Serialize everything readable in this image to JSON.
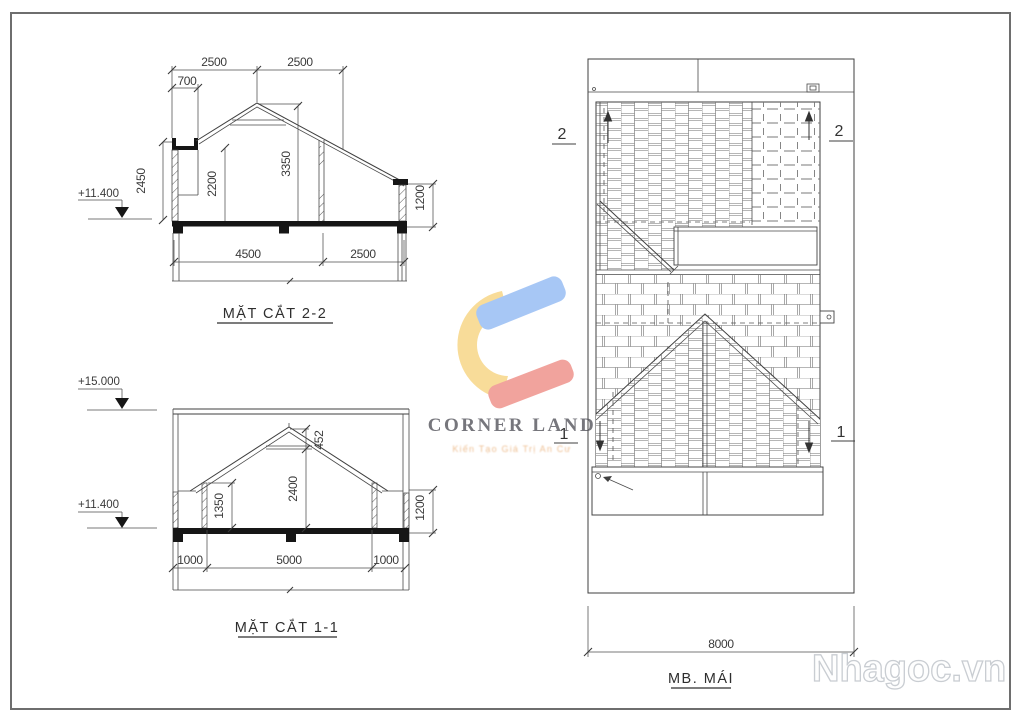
{
  "page": {
    "border_color": "#6e6e6e"
  },
  "sections": {
    "section_2_2": {
      "title": "MẶT CẮT 2-2",
      "level": "+11.400",
      "dim_top_left": "2500",
      "dim_top_right": "2500",
      "dim_eave": "700",
      "dim_parapet_height": "2450",
      "dim_ceiling_left": "2200",
      "dim_ridge_height": "3350",
      "dim_right_wall": "1200",
      "dim_span_main": "4500",
      "dim_span_right": "2500"
    },
    "section_1_1": {
      "title": "MẶT CẮT 1-1",
      "level_top": "+15.000",
      "level_floor": "+11.400",
      "dim_ridge_offset": "452",
      "dim_attic_height": "2400",
      "dim_wall_height": "1350",
      "dim_right_wall": "1200",
      "dim_span_left": "1000",
      "dim_span_mid": "5000",
      "dim_span_right": "1000"
    },
    "roof_plan": {
      "title": "MB. MÁI",
      "dim_width": "8000",
      "marker_2_left": "2",
      "marker_2_right": "2",
      "marker_1_left": "1",
      "marker_1_right": "1"
    }
  },
  "watermarks": {
    "logo_title": "CORNER LAND",
    "logo_tagline": "Kiến Tạo Giá Trị An Cư",
    "site": "Nhagoc.vn",
    "logo_colors": {
      "blue": "#9ec1f5",
      "yellow": "#f8d98e",
      "red": "#f09a93"
    }
  }
}
